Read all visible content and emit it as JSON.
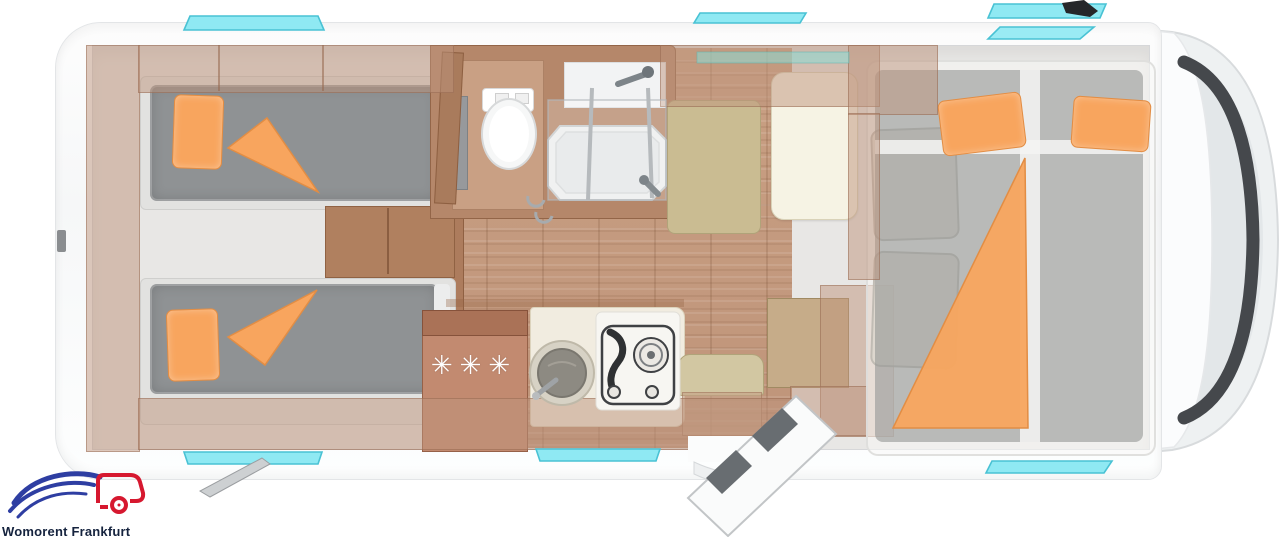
{
  "logo": {
    "text": "Womorent Frankfurt"
  },
  "fridge": {
    "symbol": "✳✳✳"
  },
  "furniture_items": [
    "rear-twin-single-beds",
    "bedroom-steps",
    "toilet",
    "shower-cabin",
    "refrigerator",
    "kitchen-sink",
    "gas-hob",
    "dinette-bench",
    "dinette-table",
    "entry-seat",
    "entry-door",
    "cab-seats",
    "drop-down-front-bed"
  ],
  "palette": {
    "body_white": "#fbfcfd",
    "interior_gray": "#e8e7e5",
    "wood_floor": "#c59c7e",
    "furniture_wood": "#b5876a",
    "mattress_gray": "#8f9294",
    "bedding_orange": "#f8a55e",
    "window_cyan": "#8fe9f3",
    "seat_beige": "#cabc92",
    "table_cream": "#f6f3e4",
    "glass_dark": "#45484c",
    "logo_blue": "#2e3ea2",
    "logo_red": "#d6182f",
    "logo_text": "#15233e"
  }
}
